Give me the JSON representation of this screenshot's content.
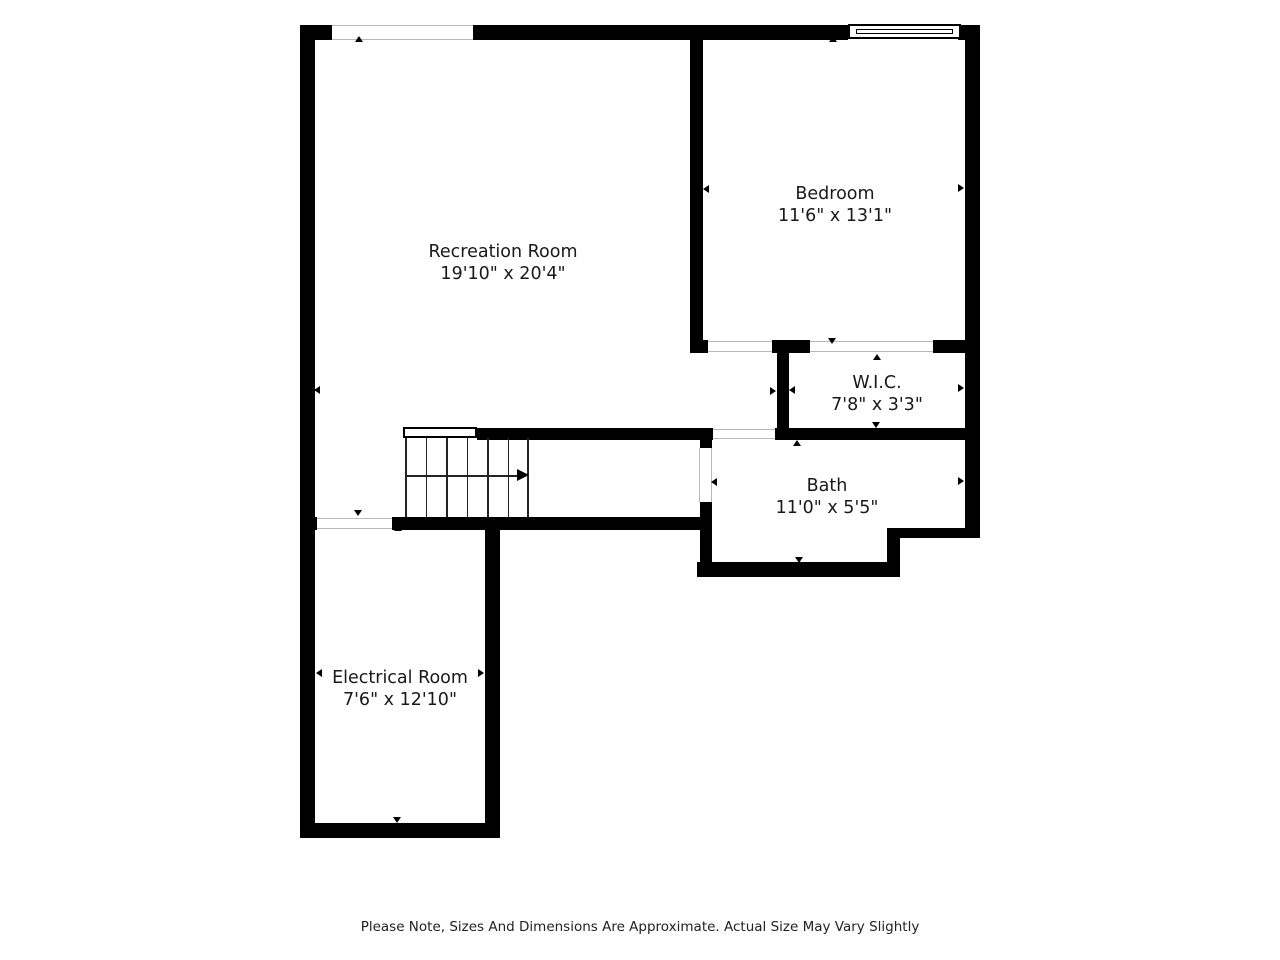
{
  "plan_title": "Basement Floor Plan",
  "rooms": [
    {
      "id": "recreation-room",
      "name": "Recreation Room",
      "dimensions": "19'10\" x 20'4\""
    },
    {
      "id": "bedroom",
      "name": "Bedroom",
      "dimensions": "11'6\" x 13'1\""
    },
    {
      "id": "wic",
      "name": "W.I.C.",
      "dimensions": "7'8\" x 3'3\""
    },
    {
      "id": "bath",
      "name": "Bath",
      "dimensions": "11'0\" x 5'5\""
    },
    {
      "id": "electrical-room",
      "name": "Electrical Room",
      "dimensions": "7'6\" x 12'10\""
    }
  ],
  "features": [
    "staircase",
    "window",
    "door-openings",
    "dimension-arrows"
  ],
  "footer": {
    "note": "Please Note, Sizes And Dimensions Are Approximate. Actual Size May Vary Slightly"
  },
  "colors": {
    "wall": "#000000",
    "background": "#ffffff",
    "opening_line": "#b8b8b8",
    "text": "#191919"
  }
}
